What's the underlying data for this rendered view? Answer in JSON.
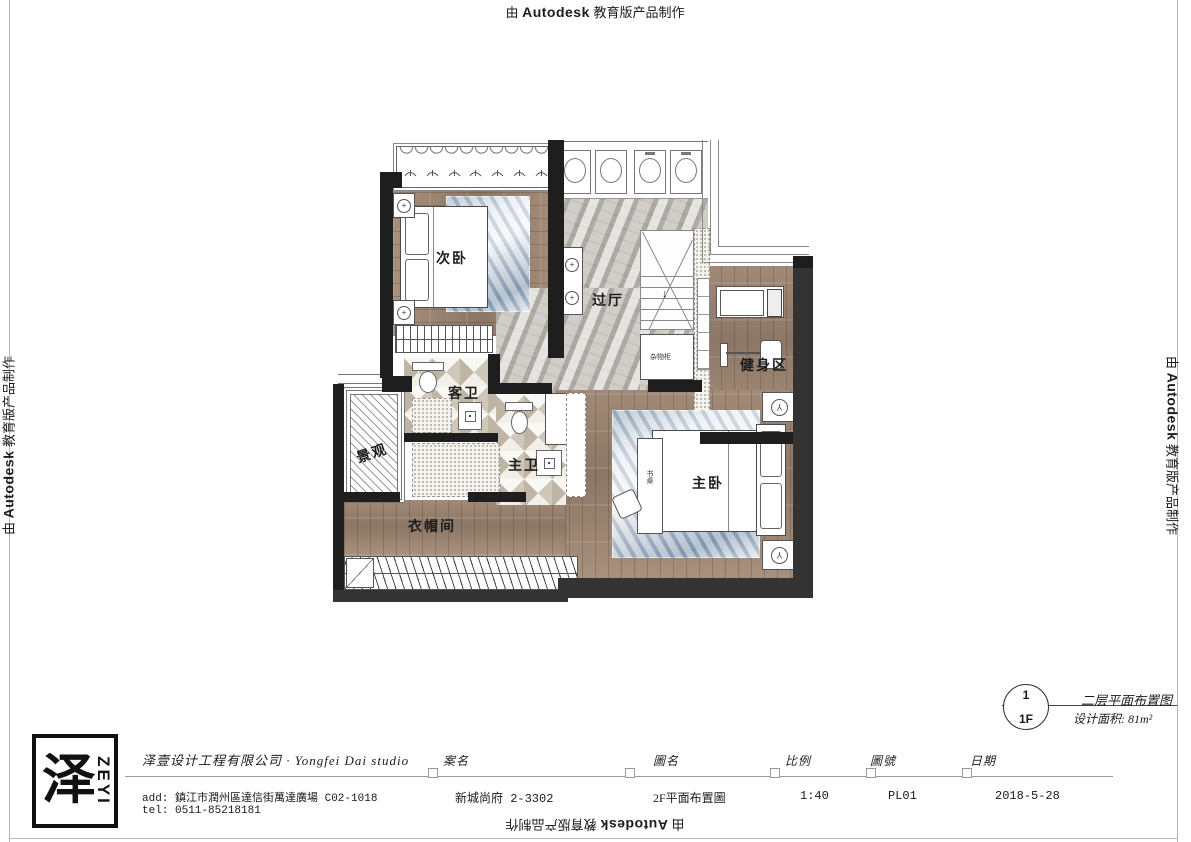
{
  "edge_note": {
    "prefix": "由",
    "brand": "Autodesk",
    "suffix": "教育版产品制作"
  },
  "drawing_ref": {
    "number": "1",
    "floor": "1F",
    "title": "二层平面布置图",
    "area": "设计面积: 81m²"
  },
  "title_block": {
    "logo_char": "泽",
    "logo_word": "ZEYI",
    "company": "泽壹设计工程有限公司 · Yongfei Dai studio",
    "address": "add: 鎮江市潤州區達信街萬達廣場 C02-1018",
    "tel": "tel: 0511-85218181",
    "fields": [
      {
        "label": "案名",
        "value": "新城尚府 2-3302"
      },
      {
        "label": "圖名",
        "value": "2F平面布置圖"
      },
      {
        "label": "比例",
        "value": "1:40"
      },
      {
        "label": "圖號",
        "value": "PL01"
      },
      {
        "label": "日期",
        "value": "2018-5-28"
      }
    ]
  },
  "floor_plan": {
    "rooms": {
      "secondary_bedroom": "次卧",
      "hallway": "过厅",
      "gym": "健身区",
      "guest_bath": "客卫",
      "view": "景观",
      "master_bath": "主卫",
      "cloakroom": "衣帽间",
      "master_bedroom": "主卧",
      "storage_cabinet": "杂物柜",
      "desk": "书桌"
    },
    "stair_arrow": "↓",
    "icons": {
      "column_symbol": "+",
      "fan_symbol": "Y"
    }
  },
  "colors": {
    "paper": "#ffffff",
    "wood": "#9a8574",
    "marble": "#c7c3bd",
    "rug": "#aebdcc",
    "wall": "#1e1e1e",
    "outer_wall": "#333333"
  }
}
